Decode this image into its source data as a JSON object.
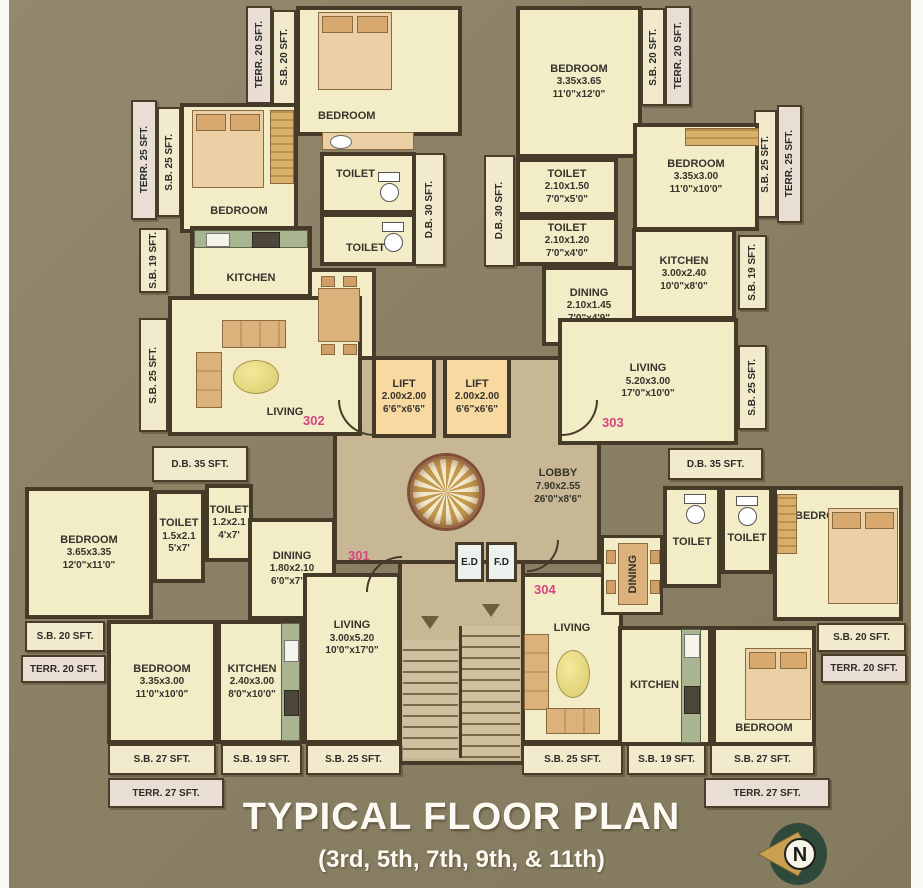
{
  "title": {
    "main": "TYPICAL FLOOR PLAN",
    "sub": "(3rd, 5th, 7th, 9th, & 11th)"
  },
  "compass": {
    "north": "N"
  },
  "core": {
    "lift": {
      "name": "LIFT",
      "m": "2.00x2.00",
      "ft": "6'6\"x6'6\""
    },
    "lobby": {
      "name": "LOBBY",
      "m": "7.90x2.55",
      "ft": "26'0\"x8'6\""
    },
    "ed": "E.D",
    "fd": "F.D",
    "db30": "D.B. 30 SFT.",
    "db35": "D.B. 35 SFT."
  },
  "units": {
    "u302": {
      "number": "302",
      "bedroom1": {
        "name": "BEDROOM"
      },
      "bedroom2": {
        "name": "BEDROOM"
      },
      "kitchen": {
        "name": "KITCHEN"
      },
      "dining": {
        "name": "DINING"
      },
      "living": {
        "name": "LIVING"
      },
      "toilet1": {
        "name": "TOILET"
      },
      "toilet2": {
        "name": "TOILET"
      },
      "strips": {
        "terr20": "TERR. 20 SFT.",
        "sb20": "S.B. 20 SFT.",
        "terr25": "TERR. 25 SFT.",
        "sb25a": "S.B. 25 SFT.",
        "sb19": "S.B. 19 SFT.",
        "sb25b": "S.B. 25 SFT."
      }
    },
    "u303": {
      "number": "303",
      "bedroom1": {
        "name": "BEDROOM",
        "m": "3.35x3.65",
        "ft": "11'0\"x12'0\""
      },
      "bedroom2": {
        "name": "BEDROOM",
        "m": "3.35x3.00",
        "ft": "11'0\"x10'0\""
      },
      "toilet1": {
        "name": "TOILET",
        "m": "2.10x1.50",
        "ft": "7'0\"x5'0\""
      },
      "toilet2": {
        "name": "TOILET",
        "m": "2.10x1.20",
        "ft": "7'0\"x4'0\""
      },
      "dining": {
        "name": "DINING",
        "m": "2.10x1.45",
        "ft": "7'0\"x4'9\""
      },
      "kitchen": {
        "name": "KITCHEN",
        "m": "3.00x2.40",
        "ft": "10'0\"x8'0\""
      },
      "living": {
        "name": "LIVING",
        "m": "5.20x3.00",
        "ft": "17'0\"x10'0\""
      },
      "strips": {
        "sb20": "S.B. 20 SFT.",
        "terr20": "TERR. 20 SFT.",
        "sb25a": "S.B. 25 SFT.",
        "terr25": "TERR. 25 SFT.",
        "sb19": "S.B. 19 SFT.",
        "sb25b": "S.B. 25 SFT."
      }
    },
    "u301": {
      "number": "301",
      "bedroom1": {
        "name": "BEDROOM",
        "m": "3.65x3.35",
        "ft": "12'0\"x11'0\""
      },
      "toilet1": {
        "name": "TOILET",
        "m": "1.5x2.1",
        "ft": "5'x7'"
      },
      "toilet2": {
        "name": "TOILET",
        "m": "1.2x2.1",
        "ft": "4'x7'"
      },
      "dining": {
        "name": "DINING",
        "m": "1.80x2.10",
        "ft": "6'0\"x7'0\""
      },
      "bedroom2": {
        "name": "BEDROOM",
        "m": "3.35x3.00",
        "ft": "11'0\"x10'0\""
      },
      "kitchen": {
        "name": "KITCHEN",
        "m": "2.40x3.00",
        "ft": "8'0\"x10'0\""
      },
      "living": {
        "name": "LIVING",
        "m": "3.00x5.20",
        "ft": "10'0\"x17'0\""
      },
      "strips": {
        "sb20": "S.B. 20 SFT.",
        "terr20": "TERR. 20 SFT.",
        "sb27": "S.B. 27 SFT.",
        "sb19": "S.B. 19 SFT.",
        "sb25": "S.B. 25 SFT.",
        "terr27": "TERR. 27 SFT."
      }
    },
    "u304": {
      "number": "304",
      "living": {
        "name": "LIVING"
      },
      "dining": {
        "name": "DINING"
      },
      "toilet1": {
        "name": "TOILET"
      },
      "toilet2": {
        "name": "TOILET"
      },
      "bedroom1": {
        "name": "BEDROOM"
      },
      "kitchen": {
        "name": "KITCHEN"
      },
      "bedroom2": {
        "name": "BEDROOM"
      },
      "strips": {
        "sb20": "S.B. 20 SFT.",
        "terr20": "TERR. 20 SFT.",
        "sb25": "S.B. 25 SFT.",
        "sb19": "S.B. 19 SFT.",
        "sb27": "S.B. 27 SFT.",
        "terr27": "TERR. 27 SFT."
      }
    }
  },
  "colors": {
    "background": "#8a8065",
    "wall": "#463a28",
    "room": "#f3edc7",
    "lobby": "#c7b795",
    "lift": "#f8d9a1",
    "counter": "#a9b491",
    "unit_number": "#d6457f",
    "title": "#fcfaf3"
  }
}
